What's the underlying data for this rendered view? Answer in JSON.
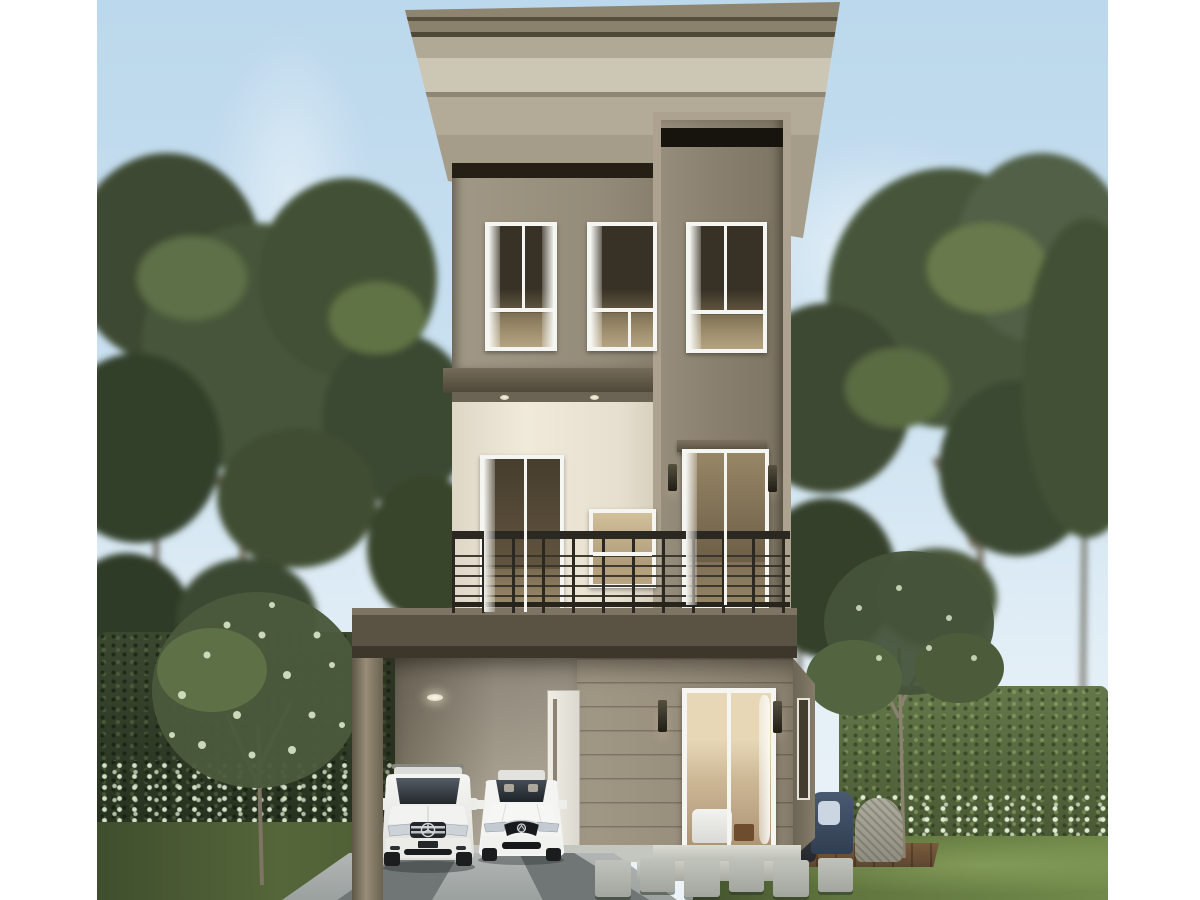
{
  "meta": {
    "type": "architectural-rendering",
    "subject": "modern three-storey detached house with carport",
    "canvas": "photo centered with white left and right margins"
  },
  "palette": {
    "sky_top": "#bcd8ec",
    "sky_bottom": "#e2eef6",
    "roof_light": "#8d8570",
    "roof_dark": "#4e4937",
    "wall_taupe": "#948b79",
    "tower_wall": "#8a8170",
    "tower_frame": "#aca28f",
    "band_dark": "#261f15",
    "slab": "#4e4738",
    "cream": "#f0eadb",
    "railing": "#2b2822",
    "balcony_slab": "#5a5242",
    "siding": "#978d7b",
    "carport_wall": "#c9c1b0",
    "door_white": "#efede5",
    "frame_white": "#f5f5f2",
    "glass_dark": "#383226",
    "interior_warm": "#6e5f48",
    "driveway": "#9ba19f",
    "step_light": "#dadbd3",
    "paver": "#c0c3bb",
    "grass_left": "#55663a",
    "grass_right": "#60753f",
    "hedge_dark": "#26301e",
    "hedge_light": "#64784a",
    "flower": "#dde8cf",
    "tree_dark": "#33402a",
    "tree_mid": "#46563a",
    "tree_light": "#5d6f46",
    "trunk": "#6b6252",
    "deck": "#7a5c3d",
    "chair_navy": "#4a5a71",
    "chair_cushion": "#ccd6e2",
    "wicker": "#adac9f",
    "ottoman": "#3a4046"
  },
  "house": {
    "storeys": 3,
    "roof": "flat cantilevered slab roof with wide tapered eaves and double fascia reveal lines",
    "tower": "full-height projecting framed bay on the right with dark glazing band at top",
    "third_floor": {
      "windows": 3,
      "window_style": "white frame, transom bar, sheer curtains, warm lit interior"
    },
    "second_floor": {
      "balcony": true,
      "railing": "dark metal railing with thin horizontal bars and vertical posts",
      "sliding_doors": 2,
      "pass_window": 1,
      "soffit_downlights": 2,
      "wall_sconces": 2,
      "door_header": "projecting taupe header above tower door"
    },
    "ground_floor": {
      "carport": true,
      "carport_post": 1,
      "ceiling_light": 1,
      "entry_door": "white single door with slim vertical glass",
      "living_room_sliding_door": "white-framed glass door showing sofa, wood table and curtain",
      "wall_sconces": 2,
      "siding": "horizontal lap siding",
      "entry_steps": 2,
      "side_return_window": 1
    }
  },
  "vehicles": [
    {
      "kind": "suv",
      "color": "white",
      "emblem": "three-pointed star in slatted chrome grille",
      "position": "carport left bay"
    },
    {
      "kind": "sedan",
      "color": "white",
      "emblem": "winged badge grille",
      "position": "carport right bay"
    }
  ],
  "landscape": {
    "sky": "clear pale-blue sky with soft white clouds",
    "trees": "tall leafy green trees flanking both sides",
    "hedge_left": "tall dark clipped hedge wall",
    "hedge_right": "sunlit clipped hedge wall",
    "flower_border": "white flowering shrub band along hedge bases",
    "lawns": "green grass left and bright lawn right",
    "driveway": "grey concrete driveway with twin dark tire strips",
    "stepping_stones": 6,
    "deck": {
      "material": "wood planks",
      "furniture": [
        "navy armchair with light cushion",
        "grey wicker chair",
        "dark ottoman"
      ]
    },
    "small_trees": [
      "white flowering tree at left foreground",
      "slender multi-stem tree beside deck"
    ]
  }
}
